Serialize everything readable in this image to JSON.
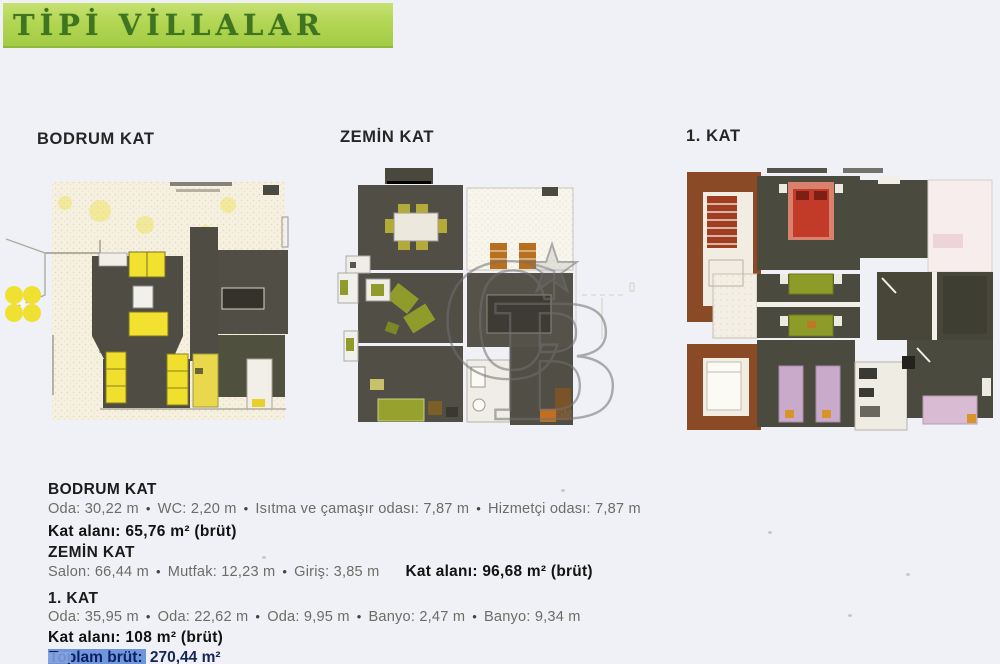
{
  "header": {
    "title": "TİPİ VİLLALAR",
    "bar_color": "#b2d653",
    "text_color": "#3f7420"
  },
  "bullet": "•",
  "plans": [
    {
      "label": "BODRUM KAT"
    },
    {
      "label": "ZEMİN KAT"
    },
    {
      "label": "1. KAT"
    }
  ],
  "watermark": {
    "letter_c": "C",
    "letter_b": "B",
    "service_mark": "SM"
  },
  "sections": [
    {
      "heading": "BODRUM KAT",
      "rooms": [
        "Oda: 30,22 m",
        "WC: 2,20 m",
        "Isıtma ve çamaşır odası: 7,87 m",
        "Hizmetçi odası: 7,87 m"
      ],
      "floor_area": "Kat alanı: 65,76 m² (brüt)"
    },
    {
      "heading": "ZEMİN KAT",
      "rooms": [
        "Salon: 66,44 m",
        "Mutfak: 12,23 m",
        "Giriş: 3,85 m"
      ],
      "floor_area": "Kat alanı: 96,68 m² (brüt)"
    },
    {
      "heading": "1. KAT",
      "rooms": [
        "Oda: 35,95 m",
        "Oda: 22,62 m",
        "Oda: 9,95 m",
        "Banyo: 2,47 m",
        "Banyo: 9,34 m"
      ],
      "floor_area": "Kat alanı: 108 m² (brüt)"
    }
  ],
  "total": {
    "label": "Toplam brüt:",
    "value": " 270,44 m²"
  }
}
